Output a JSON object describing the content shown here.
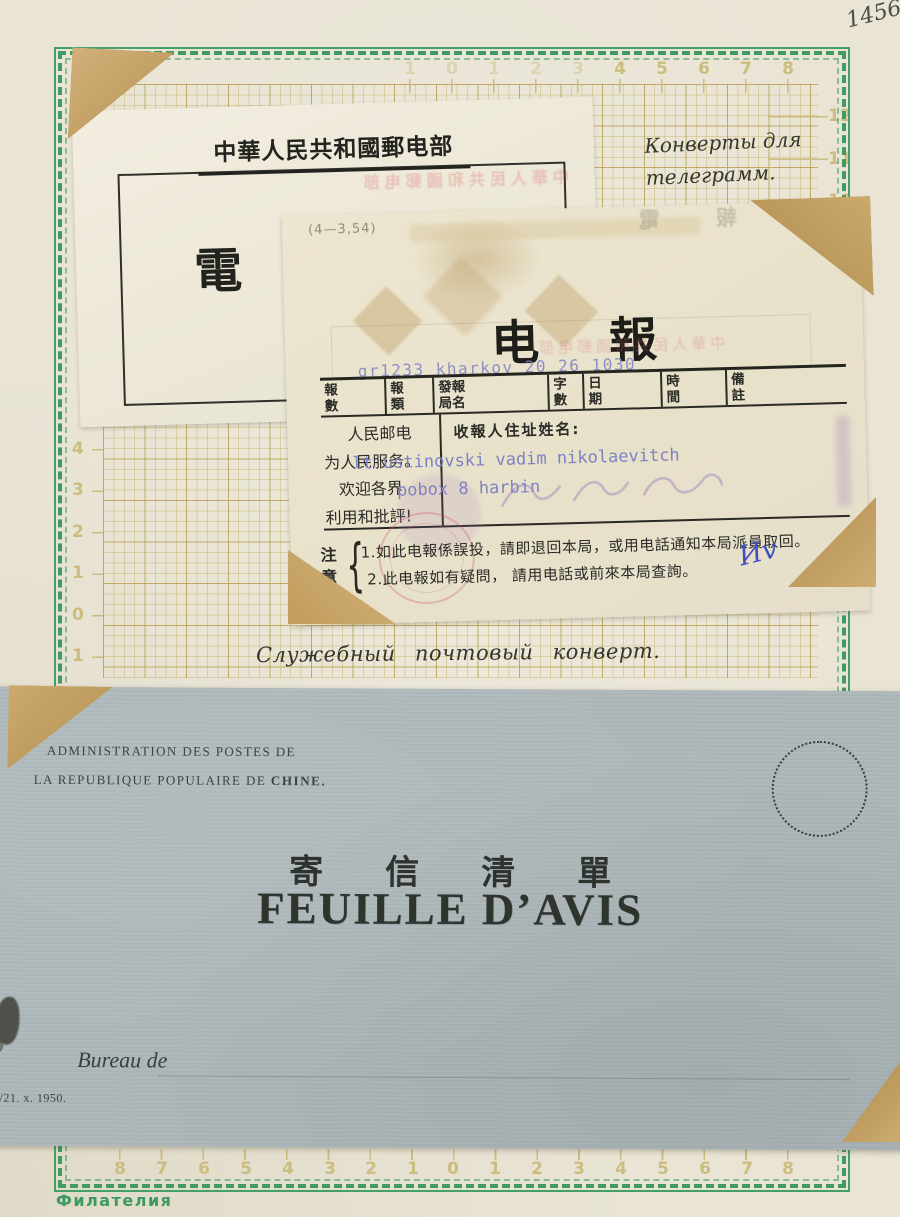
{
  "page": {
    "handwritten_number": "1456",
    "bottom_brand": "Филателия"
  },
  "captions": {
    "telegram_envelopes_line1": "Конверты для",
    "telegram_envelopes_line2": "телеграмм.",
    "service_envelope": "Служебный почтовый конверт."
  },
  "rulers": {
    "top": [
      "1",
      "0",
      "1",
      "2",
      "3",
      "4",
      "5",
      "6",
      "7",
      "8"
    ],
    "left": [
      "4",
      "3",
      "2",
      "1",
      "0",
      "1"
    ],
    "right": [
      "12",
      "11",
      "10"
    ],
    "bottom": [
      "8",
      "7",
      "6",
      "5",
      "4",
      "3",
      "2",
      "1",
      "0",
      "1",
      "2",
      "3",
      "4",
      "5",
      "6",
      "7",
      "8"
    ]
  },
  "telegram_cover": {
    "header": "中華人民共和國郵电部",
    "seal_char": "電"
  },
  "bleedthrough": {
    "cover_header_mirror": "中華人民共和國郵电部",
    "form_top_mirror": "中報電",
    "seal_mirror": "电報"
  },
  "telegram_form": {
    "form_code": "(4—3,54)",
    "title_chars": [
      "电",
      "報"
    ],
    "typed_service_line": "gr1233 kharkov 20 26 1030",
    "table_headers": [
      "報數",
      "報類",
      "發報局名",
      "字數",
      "日期",
      "時間",
      "備註"
    ],
    "slogan_lines": [
      "人民邮电",
      "为人民服务。",
      "欢迎各界",
      "利用和批評!"
    ],
    "recipient_label": "收報人住址姓名:",
    "typed_recipient_line1": "lt ustinovski vadim nikolaevitch",
    "typed_recipient_line2": "pobox 8 harbin",
    "notice_label": "注意",
    "notice_brace": "{",
    "notice_items": [
      "1.如此电報係誤投，請即退回本局，或用电話通知本局派員取回。",
      "2.此电報如有疑問， 請用电話或前來本局查詢。"
    ],
    "ink_initials": "Иv"
  },
  "envelope": {
    "admin_line1": "ADMINISTRATION DES POSTES DE",
    "admin_line2_prefix": "LA REPUBLIQUE POPULAIRE DE ",
    "admin_line2_bold": "CHINE.",
    "title_chinese": "寄信清單",
    "title_french": "FEUILLE D’AVIS",
    "bureau_label": "Bureau de",
    "imprint": "0/21. x. 1950."
  },
  "colors": {
    "page_bg": "#e9e4d4",
    "border_green": "#3f9b62",
    "grid_line": "#c9b670",
    "form_paper": "#ebe5d2",
    "envelope_blue": "#aeb8ba",
    "typed_blue": "#7e81c5",
    "mount_tan": "#c8a468",
    "ink_black": "#2a2a26"
  }
}
